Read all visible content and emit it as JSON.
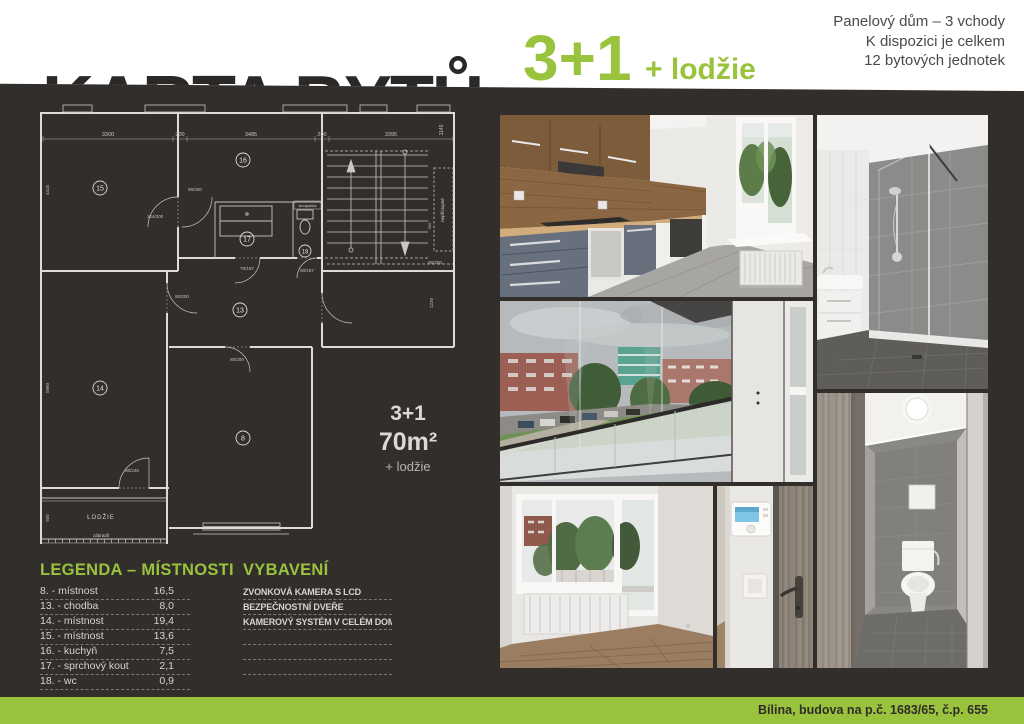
{
  "colors": {
    "accent_green": "#9ac33d",
    "background_dark": "#312e2c",
    "band_white": "#ffffff"
  },
  "header": {
    "title": "KARTA BYTŮ",
    "layout": "3+1",
    "layout_suffix": "+ lodžie",
    "info_lines": [
      "Panelový dům – 3 vchody",
      "K dispozici je celkem",
      "12 bytových jednotek"
    ]
  },
  "floor_plan": {
    "rooms": {
      "r8": "8",
      "r13": "13",
      "r14": "14",
      "r15": "15",
      "r16": "16",
      "r17": "17",
      "r18": "18"
    },
    "dims": {
      "top1": "3300",
      "top2": "200",
      "top3": "3485",
      "top4": "200",
      "top5": "3395",
      "right_v": "1145",
      "left_v1": "4415",
      "left_v2": "5960",
      "left_v3": "920",
      "stair_v": "350",
      "corr_v": "1220",
      "door1": "124/200",
      "door2": "80/200",
      "door3": "80/200",
      "door4": "80/200",
      "door5": "70/197",
      "door6": "60/197",
      "door7": "80/245",
      "door8": "80/200"
    },
    "labels": {
      "loggia": "LODŽIE",
      "railing": "zábradlí",
      "riser": "sloupačka",
      "note": "nepřístupné"
    },
    "summary": {
      "layout": "3+1",
      "area": "70m²",
      "extra": "+ lodžie"
    }
  },
  "legend": {
    "title": "LEGENDA – MÍSTNOSTI",
    "rows": [
      {
        "label": "8. - místnost",
        "value": "16,5"
      },
      {
        "label": "13. - chodba",
        "value": "8,0"
      },
      {
        "label": "14. - místnost",
        "value": "19,4"
      },
      {
        "label": "15. - místnost",
        "value": "13,6"
      },
      {
        "label": "16. - kuchyň",
        "value": "7,5"
      },
      {
        "label": "17. - sprchový kout",
        "value": "2,1"
      },
      {
        "label": "18. - wc",
        "value": "0,9"
      }
    ]
  },
  "equipment": {
    "title": "VYBAVENÍ",
    "items": [
      "ZVONKOVÁ KAMERA S LCD",
      "BEZPEČNOSTNÍ DVEŘE",
      "KAMEROVÝ SYSTÉM V CELÉM DOMĚ",
      "",
      "",
      ""
    ]
  },
  "footer": {
    "address": "Bílina, budova na p.č. 1683/65, č.p. 655"
  }
}
